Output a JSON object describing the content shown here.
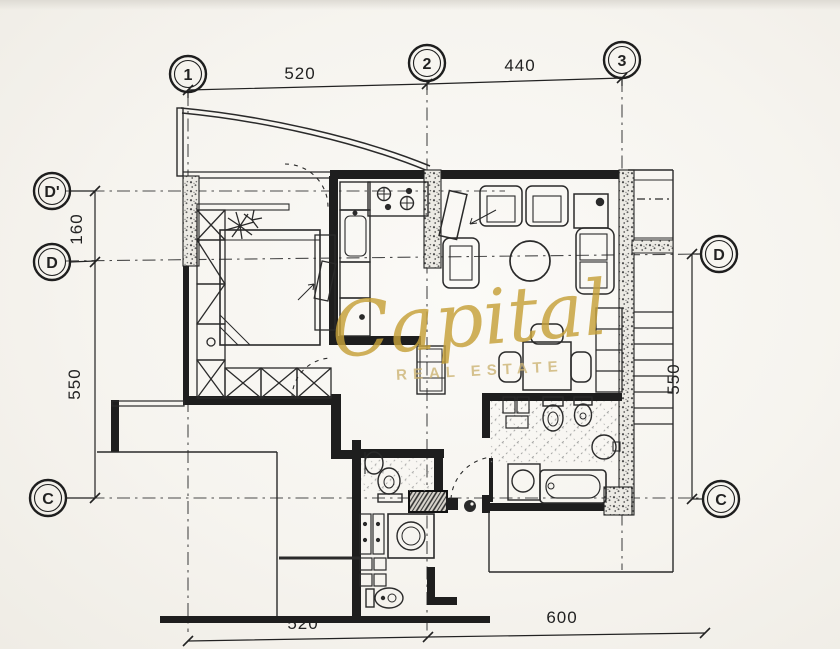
{
  "watermark": {
    "name": "Capital",
    "subtitle": "REAL ESTATE",
    "color": "#c6a139",
    "subtitle_color": "#cdb474"
  },
  "grid_markers": {
    "top": [
      "1",
      "2",
      "3"
    ],
    "left": [
      "D'",
      "D",
      "C"
    ],
    "right": [
      "D",
      "C"
    ]
  },
  "dimensions": {
    "top": [
      "520",
      "440"
    ],
    "left": [
      "160",
      "550"
    ],
    "right": [
      "550"
    ],
    "bottom": [
      "520",
      "600"
    ]
  },
  "colors": {
    "paper": "#f6f4ef",
    "ink": "#222222",
    "grid_line": "#444444",
    "watermark_gold": "#c6a139"
  },
  "rooms": [
    {
      "name": "terrace",
      "fixtures": [
        "curved-balcony-wall"
      ]
    },
    {
      "name": "bedroom",
      "fixtures": [
        "double-bed",
        "wardrobe-column",
        "wardrobe-row",
        "plant",
        "mirror-cabinet"
      ]
    },
    {
      "name": "kitchen",
      "fixtures": [
        "stove-4-burners",
        "kitchen-sink",
        "counter-cabinets"
      ]
    },
    {
      "name": "living-room",
      "fixtures": [
        "tv",
        "armchair",
        "armchair",
        "armchair",
        "round-table",
        "side-table",
        "sofa"
      ]
    },
    {
      "name": "dining-area",
      "fixtures": [
        "dining-table",
        "chair",
        "chair",
        "chair",
        "shelf-unit"
      ]
    },
    {
      "name": "bathroom",
      "fixtures": [
        "vanity",
        "toilet",
        "bidet",
        "round-washbasin",
        "vanity-basin",
        "bathtub",
        "door-leaf"
      ]
    },
    {
      "name": "wc",
      "fixtures": [
        "washbasin",
        "toilet",
        "duct-shaft"
      ]
    },
    {
      "name": "laundry",
      "fixtures": [
        "cabinets",
        "washing-machine",
        "toilet",
        "washbasin"
      ]
    },
    {
      "name": "staircase",
      "fixtures": [
        "stairs",
        "landing"
      ]
    }
  ]
}
